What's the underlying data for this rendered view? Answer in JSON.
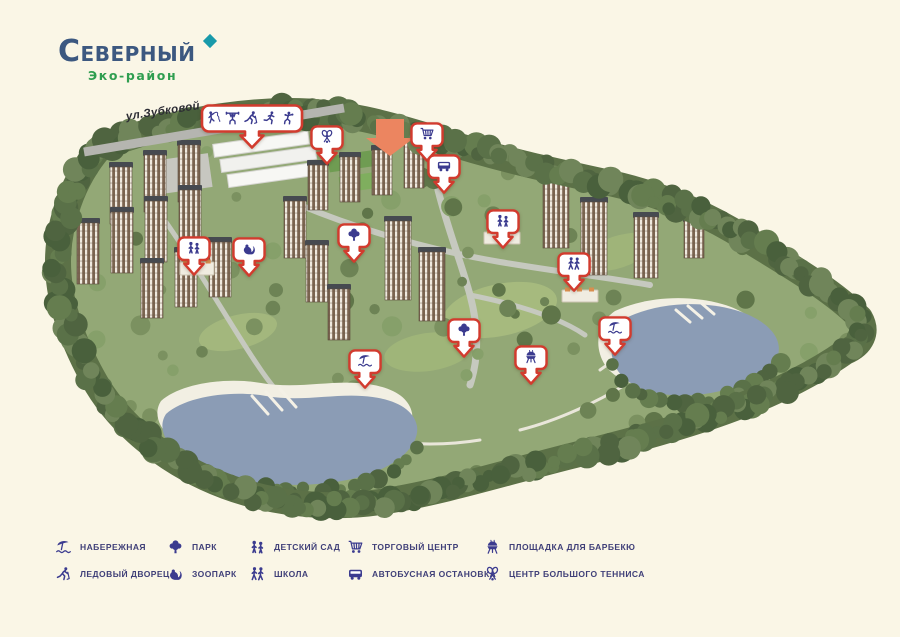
{
  "logo": {
    "title": "СЕВЕРНЫЙ",
    "subtitle": "Эко-район"
  },
  "map": {
    "street_label": "ул.Зубковой",
    "highlight_arrow_color": "#ec8560",
    "markers": [
      {
        "id": "sports-complex",
        "type": "wide",
        "icons": [
          "gymnast",
          "weightlifter",
          "hockey",
          "runner",
          "boxer"
        ],
        "x": 252,
        "y": 104
      },
      {
        "id": "tennis-center",
        "icon": "tennis",
        "x": 327,
        "y": 125
      },
      {
        "id": "shopping-center",
        "icon": "cart",
        "x": 427,
        "y": 122
      },
      {
        "id": "bus-stop",
        "icon": "bus",
        "x": 444,
        "y": 154
      },
      {
        "id": "kindergarten-west",
        "icon": "kindergarten",
        "x": 194,
        "y": 236
      },
      {
        "id": "zoo",
        "icon": "zoo",
        "x": 249,
        "y": 237
      },
      {
        "id": "park-north",
        "icon": "park",
        "x": 354,
        "y": 223
      },
      {
        "id": "kindergarten-east",
        "icon": "kindergarten",
        "x": 503,
        "y": 209
      },
      {
        "id": "school",
        "icon": "school",
        "x": 574,
        "y": 252
      },
      {
        "id": "park-south",
        "icon": "park",
        "x": 464,
        "y": 318
      },
      {
        "id": "bbq-area",
        "icon": "bbq",
        "x": 531,
        "y": 345
      },
      {
        "id": "embankment-east",
        "icon": "embankment",
        "x": 615,
        "y": 316
      },
      {
        "id": "embankment-west",
        "icon": "embankment",
        "x": 365,
        "y": 349
      }
    ]
  },
  "legend": {
    "items": [
      {
        "icon": "embankment",
        "label": "НАБЕРЕЖНАЯ"
      },
      {
        "icon": "park",
        "label": "ПАРК"
      },
      {
        "icon": "kindergarten",
        "label": "ДЕТСКИЙ САД"
      },
      {
        "icon": "cart",
        "label": "ТОРГОВЫЙ ЦЕНТР"
      },
      {
        "icon": "bbq",
        "label": "ПЛОЩАДКА ДЛЯ БАРБЕКЮ"
      },
      {
        "icon": "hockey",
        "label": "ЛЕДОВЫЙ ДВОРЕЦ"
      },
      {
        "icon": "zoo",
        "label": "ЗООПАРК"
      },
      {
        "icon": "school",
        "label": "ШКОЛА"
      },
      {
        "icon": "bus",
        "label": "АВТОБУСНАЯ ОСТАНОВКА"
      },
      {
        "icon": "tennis",
        "label": "ЦЕНТР БОЛЬШОГО ТЕННИСА"
      }
    ]
  },
  "colors": {
    "background": "#faf6e6",
    "marker_red": "#d23b2e",
    "icon_blue": "#3b3b8f",
    "logo_blue": "#3c5880",
    "logo_teal": "#189aaa",
    "logo_green": "#2f9e50",
    "water": "#8b9cb5",
    "highlight_orange": "#ec8560"
  }
}
